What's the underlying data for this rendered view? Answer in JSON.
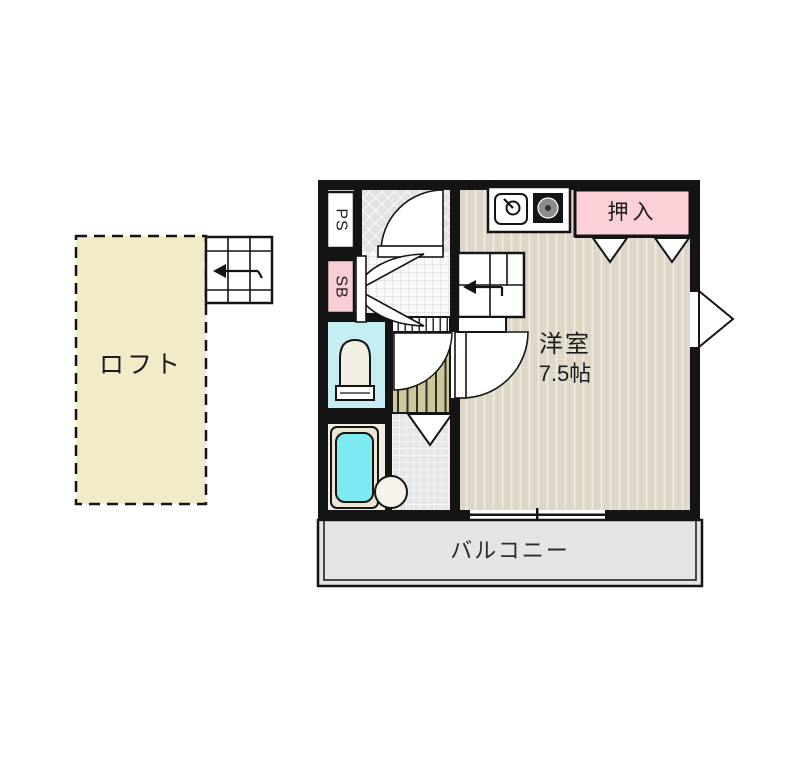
{
  "plan": {
    "title": "1R loft apartment floor plan",
    "loft": {
      "label": "ロフト"
    },
    "pipe_space": {
      "label": "PS"
    },
    "shoe_box": {
      "label": "SB"
    },
    "main_room": {
      "name": "洋室",
      "size": "7.5帖"
    },
    "closet": {
      "label": "押入"
    },
    "balcony": {
      "label": "バルコニー"
    }
  },
  "colors": {
    "wall": "#141414",
    "loft_fill": "#f1ebc8",
    "closet_pink": "#fbd0d6",
    "toilet_floor_cyan": "#c5eef2",
    "bathtub_cyan": "#7deaf2",
    "main_floor_beige": "#ded7c8",
    "stairs_khaki": "#cdc79e",
    "balcony_gray": "#e4e4e4"
  },
  "icons": [
    "stairs-icon",
    "kitchen-sink-icon",
    "gas-burner-icon",
    "toilet-icon",
    "bathtub-icon",
    "wash-basin-icon",
    "entrance-arrow-icon",
    "door-swing-icon",
    "sliding-door-icon",
    "window-icon"
  ]
}
